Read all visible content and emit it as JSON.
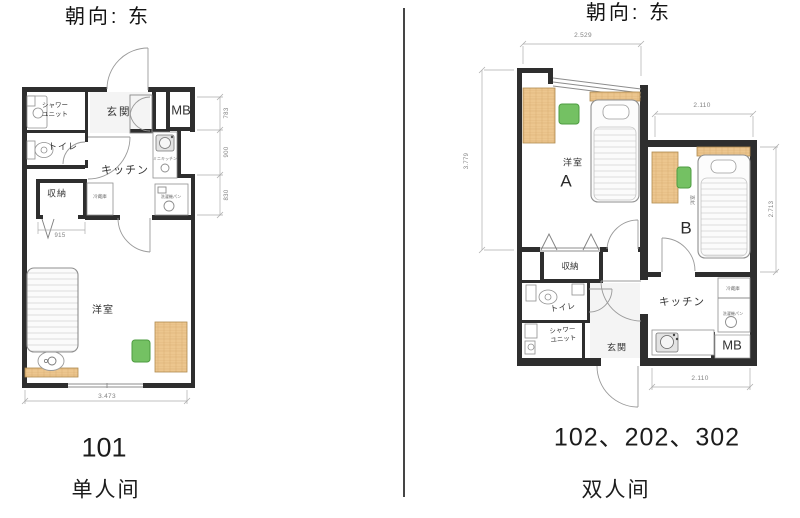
{
  "colors": {
    "wall": "#2e2e2e",
    "wood": "#ecc68e",
    "chair": "#74c163",
    "dim_text": "#828282"
  },
  "left_plan": {
    "title": "朝向: 东",
    "unit_number": "101",
    "room_type": "单人间",
    "labels": {
      "shower": "シャワーユニット",
      "toilet": "トイレ",
      "entrance": "玄関",
      "meter_box": "MB",
      "kitchen": "キッチン",
      "storage": "収納",
      "bedroom": "洋室",
      "fridge": "冷蔵庫",
      "mini_kitchen": "ミニキッチン",
      "washer_pan": "洗濯機パン"
    },
    "dimensions": {
      "bottom_width": "3.473",
      "storage_width": "915",
      "right_top": "783",
      "right_middle": "900",
      "right_bottom": "830"
    }
  },
  "right_plan": {
    "title": "朝向: 东",
    "unit_numbers": "102、202、302",
    "room_type": "双人间",
    "labels": {
      "room": "洋室",
      "room_a": "A",
      "room_b": "B",
      "room_b_small": "洋室",
      "storage": "収納",
      "toilet": "トイレ",
      "shower": "シャワーユニット",
      "entrance": "玄関",
      "kitchen": "キッチン",
      "meter_box": "MB",
      "fridge": "冷蔵庫",
      "washer_pan": "洗濯機パン"
    },
    "dimensions": {
      "top_width": "2.529",
      "left_height": "3.779",
      "room_b_width": "2.110",
      "room_b_height": "2.713",
      "bottom_width": "2.110"
    }
  }
}
